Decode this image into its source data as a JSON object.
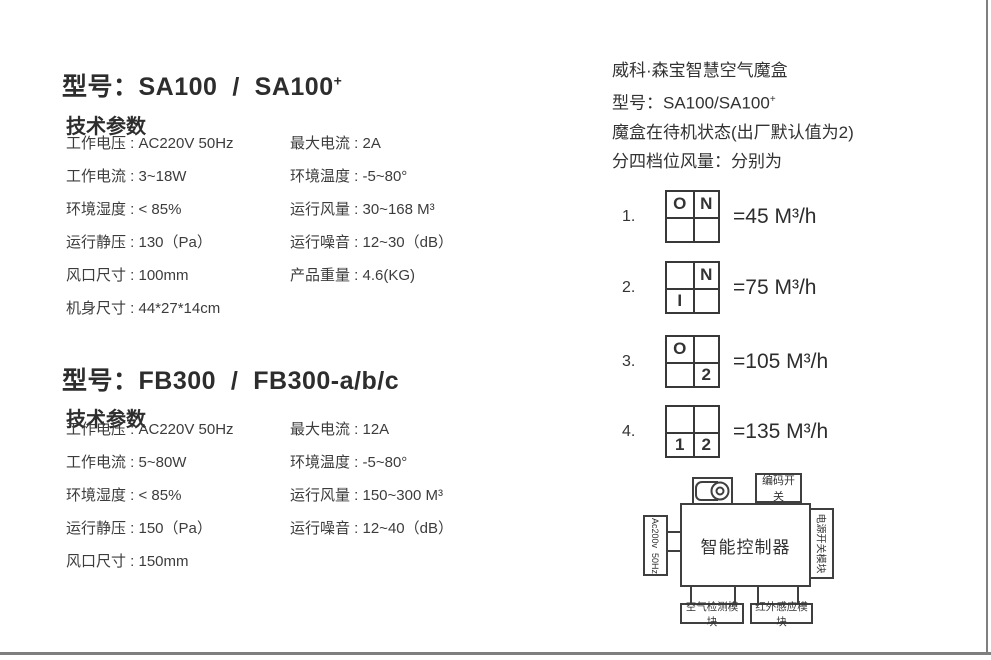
{
  "colors": {
    "ink": "#343434",
    "diagram_line": "#3f3f3f",
    "page_border": "#7f7f7f"
  },
  "models": [
    {
      "title": "型号：SA100  /  SA100",
      "title_sup": "+",
      "section_heading": "技术参数",
      "rows": [
        {
          "l": "工作电压 : AC220V 50Hz",
          "r": "最大电流 : 2A"
        },
        {
          "l": "工作电流 : 3~18W",
          "r": "环境温度 : -5~80°"
        },
        {
          "l": "环境湿度 : < 85%",
          "r": "运行风量 : 30~168 M³"
        },
        {
          "l": "运行静压 : 130（Pa）",
          "r": "运行噪音 : 12~30（dB）"
        },
        {
          "l": "风口尺寸 : 100mm",
          "r": "产品重量 : 4.6(KG)"
        },
        {
          "l": "机身尺寸 : 44*27*14cm",
          "r": ""
        }
      ]
    },
    {
      "title": "型号：FB300  /  FB300-a/b/c",
      "title_sup": "",
      "section_heading": "技术参数",
      "rows": [
        {
          "l": "工作电压 : AC220V 50Hz",
          "r": "最大电流 : 12A"
        },
        {
          "l": "工作电流 : 5~80W",
          "r": "环境温度 : -5~80°"
        },
        {
          "l": "环境湿度 : < 85%",
          "r": "运行风量 : 150~300 M³"
        },
        {
          "l": "运行静压 : 150（Pa）",
          "r": "运行噪音 : 12~40（dB）"
        },
        {
          "l": "风口尺寸 : 150mm",
          "r": ""
        }
      ]
    }
  ],
  "right_panel": {
    "brand_line": "威科·森宝智慧空气魔盒",
    "model_line": "型号：SA100/SA100",
    "model_sup": "+",
    "standby_line": "魔盒在待机状态(出厂默认值为2)",
    "gear_intro_line": "分四档位风量：分别为",
    "gears": [
      {
        "num": "1.",
        "cells": [
          "O",
          "N",
          "",
          ""
        ],
        "value": "=45 M³/h"
      },
      {
        "num": "2.",
        "cells": [
          "",
          "N",
          "I",
          ""
        ],
        "value": "=75 M³/h"
      },
      {
        "num": "3.",
        "cells": [
          "O",
          "",
          "",
          "2"
        ],
        "value": "=105 M³/h"
      },
      {
        "num": "4.",
        "cells": [
          "",
          "",
          "1",
          "2"
        ],
        "value": "=135 M³/h"
      }
    ]
  },
  "diagram": {
    "controller_label": "智能控制器",
    "coding_switch_label": "编码开关",
    "power_input_label": "Ac200v  50Hz",
    "power_switch_module_label": "电源开关模块",
    "air_detect_module_label": "空气检测模块",
    "infrared_module_label": "红外感应模块",
    "fan_icon": "blower-fan"
  }
}
